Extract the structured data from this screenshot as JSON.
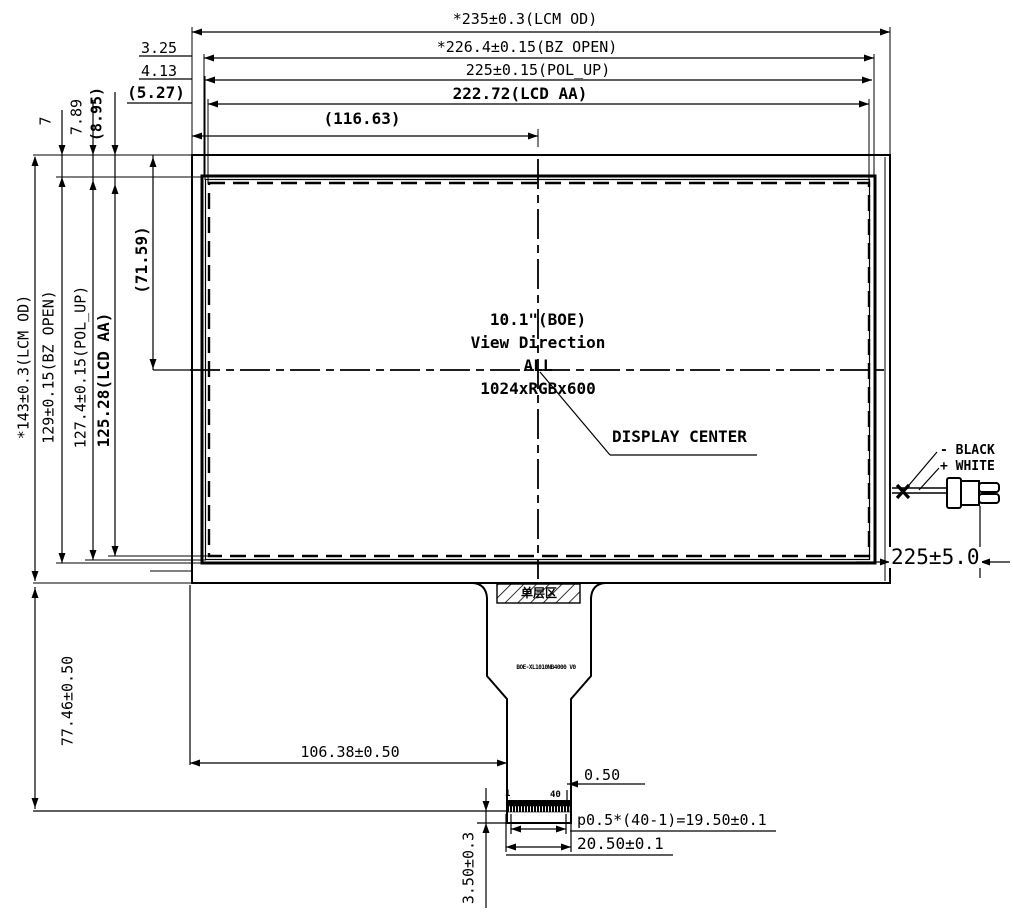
{
  "drawing": {
    "type": "LCD module outline dimension drawing",
    "line_color": "#000000",
    "background": "#ffffff"
  },
  "top_dims": {
    "lcm_od": "*235±0.3(LCM OD)",
    "bz_open": "*226.4±0.15(BZ OPEN)",
    "pol_up": "225±0.15(POL_UP)",
    "lcd_aa": "222.72(LCD AA)",
    "half_width": "(116.63)",
    "offset_bz": "3.25",
    "offset_pol": "4.13",
    "offset_aa": "(5.27)"
  },
  "left_dims": {
    "lcm_od": "*143±0.3(LCM OD)",
    "bz_open": "129±0.15(BZ OPEN)",
    "pol_up": "127.4±0.15(POL_UP)",
    "lcd_aa": "125.28(LCD AA)",
    "half_height": "(71.59)",
    "offset_bz_top": "7",
    "offset_pol_top": "7.89",
    "offset_aa_top": "(8.95)"
  },
  "center_block": {
    "line1": "10.1\"(BOE)",
    "line2": "View Direction",
    "line3": "ALL",
    "line4": "1024xRGBx600",
    "callout": "DISPLAY CENTER"
  },
  "wire": {
    "negative_label": "- BLACK",
    "positive_label": "+ WHITE",
    "length": "225±5.0"
  },
  "fpc": {
    "hatch_label": "单层区",
    "part_number": "BOE-XL1010NB4000 V0",
    "pin_first": "1",
    "pin_last": "40",
    "pin_edge_margin": "0.50",
    "pitch_formula": "p0.5*(40-1)=19.50±0.1",
    "tail_width": "20.50±0.1",
    "tip_height": "3.50±0.3",
    "tail_length": "77.46±0.50",
    "connector_offset": "106.38±0.50"
  }
}
